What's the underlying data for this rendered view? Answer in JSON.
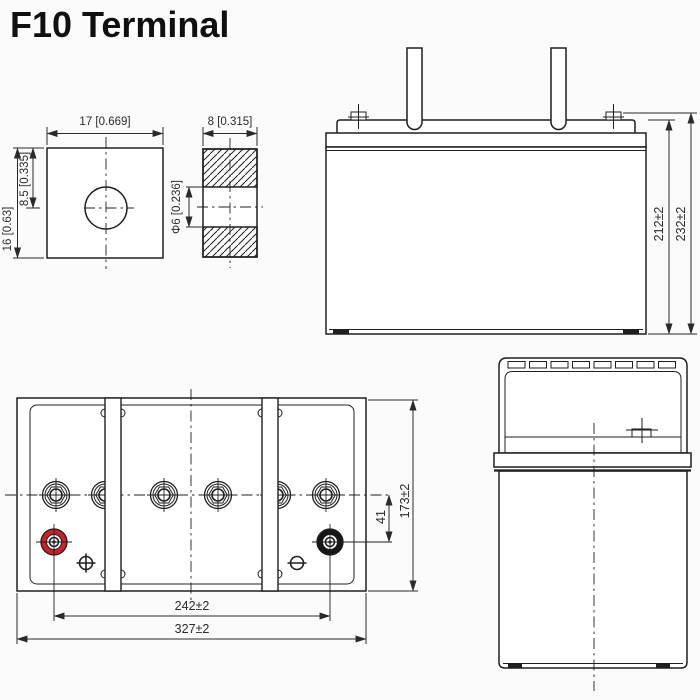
{
  "title": "F10 Terminal",
  "colors": {
    "line": "#1f1f1f",
    "positive_terminal_red": "#cb2027",
    "negative_terminal_black": "#161616",
    "background": "#fbfbfb"
  },
  "terminal_front_view": {
    "width_mm_in": "17 [0.669]",
    "height_mm_in": "16 [0.63]",
    "hole_offset_mm_in": "8.5 [0.335]"
  },
  "terminal_section_view": {
    "thickness_mm_in": "8 [0.315]",
    "hole_diameter_mm_in": "Φ6 [0.236]"
  },
  "battery_side_view": {
    "container_height_mm": "212±2",
    "overall_height_mm": "232±2"
  },
  "battery_top_view": {
    "terminal_offset_mm": "41",
    "overall_width_mm": "173±2",
    "terminal_pitch_mm": "242±2",
    "overall_length_mm": "327±2"
  }
}
